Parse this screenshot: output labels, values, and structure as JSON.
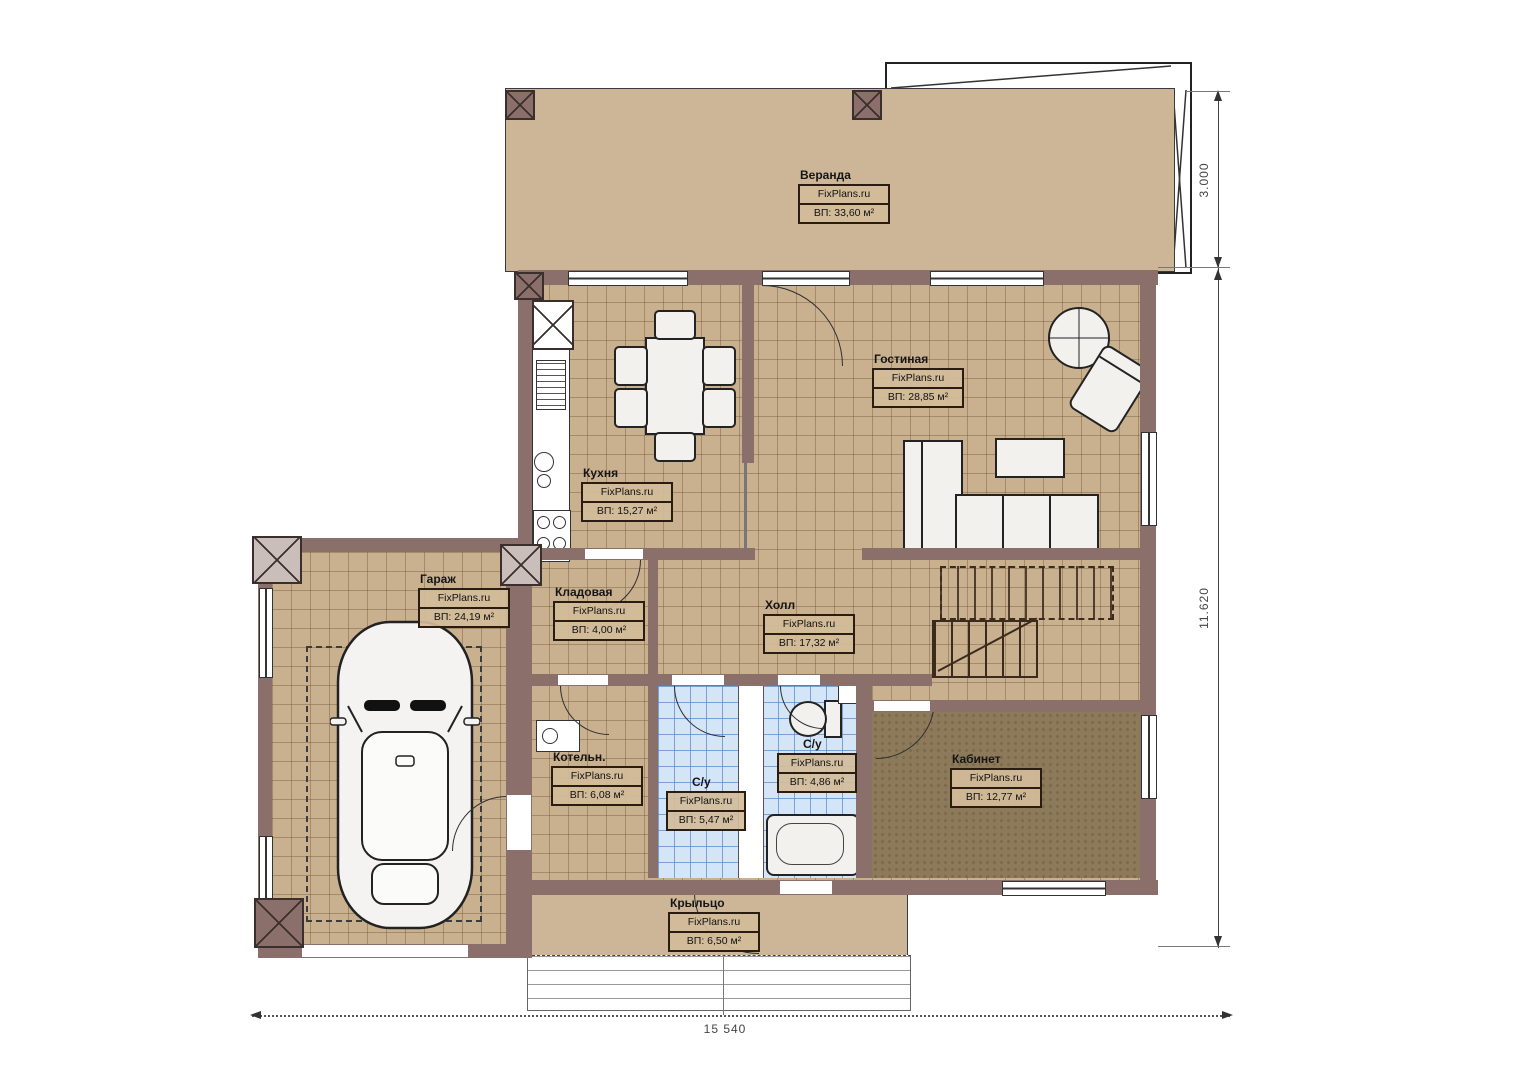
{
  "plan": {
    "watermark": "FixPlans.ru",
    "rooms": [
      {
        "name": "Веранда",
        "area": "ВП: 33,60 м²"
      },
      {
        "name": "Гостиная",
        "area": "ВП: 28,85 м²"
      },
      {
        "name": "Кухня",
        "area": "ВП: 15,27 м²"
      },
      {
        "name": "Гараж",
        "area": "ВП: 24,19 м²"
      },
      {
        "name": "Кладовая",
        "area": "ВП: 4,00 м²"
      },
      {
        "name": "Холл",
        "area": "ВП: 17,32 м²"
      },
      {
        "name": "Котельн.",
        "area": "ВП: 6,08 м²"
      },
      {
        "name": "С/у",
        "area": "ВП: 5,47 м²"
      },
      {
        "name": "С/у",
        "area": "ВП: 4,86 м²"
      },
      {
        "name": "Кабинет",
        "area": "ВП: 12,77 м²"
      },
      {
        "name": "Крыльцо",
        "area": "ВП: 6,50 м²"
      }
    ],
    "dimensions": {
      "veranda_depth": "3.000",
      "house_side": "11.620",
      "total_width": "15 540"
    },
    "colors": {
      "wall": "#8a6f6b",
      "floor_tile": "#c9b190",
      "veranda_floor": "#cdb698",
      "bathroom_tile": "#d3e5f6",
      "office_floor": "#8c7a5b"
    }
  }
}
